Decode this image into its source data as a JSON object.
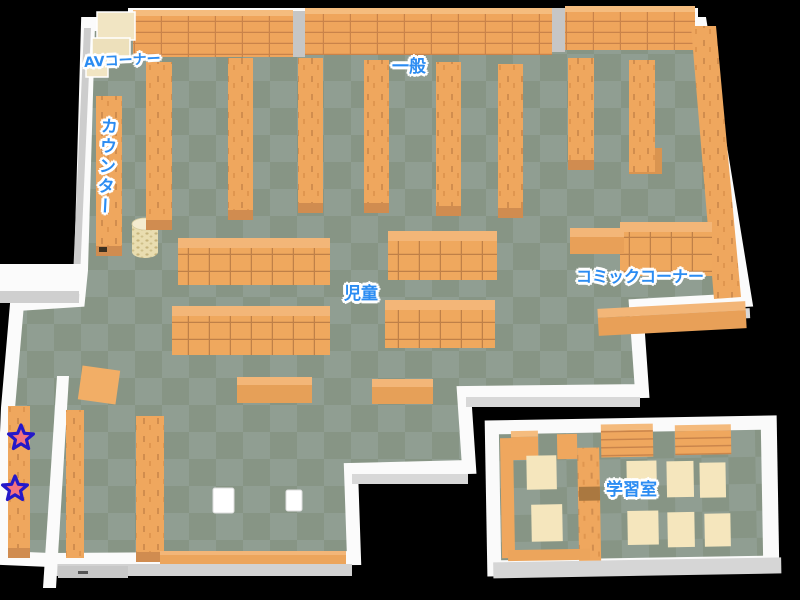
{
  "map": {
    "labels": {
      "av_corner": "AVコーナー",
      "general": "一般",
      "counter": "カウンター",
      "children": "児童",
      "comic_corner": "コミックコーナー",
      "study_room": "学習室"
    },
    "markers": {
      "star_count": 2
    },
    "colors": {
      "background": "#000000",
      "wall_white": "#fbfbfb",
      "wall_gray": "#d2d2d2",
      "floor_green_light": "#909e92",
      "floor_green_dark": "#879585",
      "shelf_orange": "#efa75e",
      "shelf_orange_dark": "#d08c50",
      "shelf_line": "#c8834a",
      "table_cream": "#f5e6bd",
      "av_unit_cream": "#f1e5c3",
      "label_blue": "#2b8cf2",
      "label_outline": "#ffffff",
      "star_pink": "#f4737f",
      "star_outline": "#2418c9"
    }
  }
}
